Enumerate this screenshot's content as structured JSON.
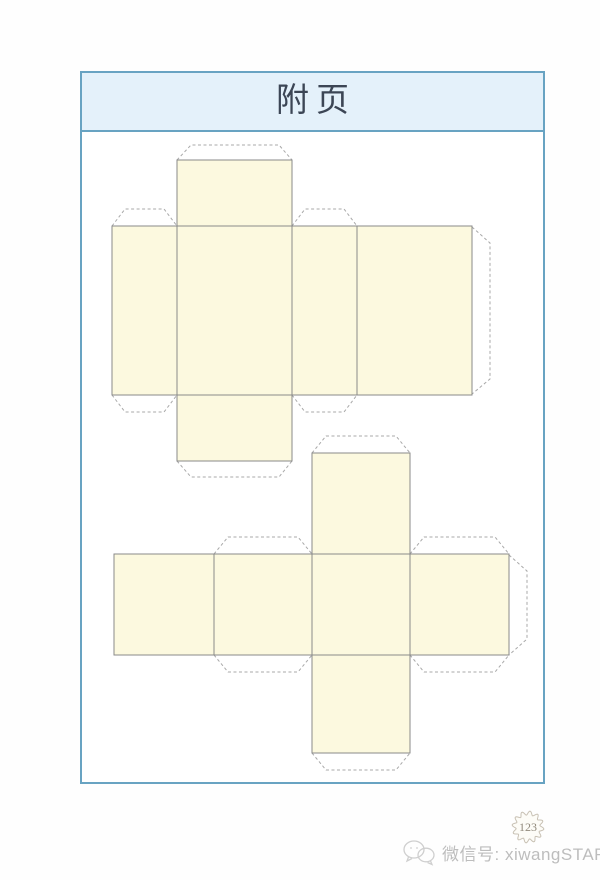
{
  "page": {
    "title": "附页",
    "page_number": "123",
    "watermark_text": "微信号: xiwangSTAR"
  },
  "colors": {
    "frame_border": "#68a3c2",
    "header_fill": "#e4f1fa",
    "title_color": "#3c4655",
    "face_fill": "#fcf9df",
    "solid_line": "#8a8a8a",
    "dashed_line": "#a9a9a9",
    "watermark": "#bdbdbd",
    "wechat_icon_stroke": "#cfcfcf",
    "badge_stroke": "#c8c1b4",
    "badge_fill": "#fdfcf7",
    "badge_text": "#918a7c"
  },
  "nets": [
    {
      "name": "cuboid-box-net",
      "faces": [
        [
          177,
          160,
          115,
          66
        ],
        [
          112,
          226,
          65,
          169
        ],
        [
          177,
          226,
          115,
          169
        ],
        [
          292,
          226,
          65,
          169
        ],
        [
          357,
          226,
          115,
          169
        ],
        [
          177,
          395,
          115,
          66
        ]
      ],
      "tabs": [
        [
          [
            177,
            160
          ],
          [
            191,
            145
          ],
          [
            279,
            145
          ],
          [
            292,
            160
          ]
        ],
        [
          [
            112,
            226
          ],
          [
            125,
            209
          ],
          [
            164,
            209
          ],
          [
            177,
            226
          ]
        ],
        [
          [
            292,
            226
          ],
          [
            305,
            209
          ],
          [
            344,
            209
          ],
          [
            357,
            226
          ]
        ],
        [
          [
            472,
            227
          ],
          [
            490,
            243
          ],
          [
            490,
            379
          ],
          [
            472,
            394
          ]
        ],
        [
          [
            112,
            395
          ],
          [
            125,
            412
          ],
          [
            164,
            412
          ],
          [
            177,
            395
          ]
        ],
        [
          [
            292,
            395
          ],
          [
            305,
            412
          ],
          [
            344,
            412
          ],
          [
            357,
            395
          ]
        ],
        [
          [
            177,
            461
          ],
          [
            191,
            477
          ],
          [
            279,
            477
          ],
          [
            292,
            461
          ]
        ]
      ]
    },
    {
      "name": "cube-box-net",
      "faces": [
        [
          312,
          453,
          98,
          101
        ],
        [
          114,
          554,
          100,
          101
        ],
        [
          214,
          554,
          98,
          101
        ],
        [
          312,
          554,
          98,
          101
        ],
        [
          410,
          554,
          99,
          101
        ],
        [
          312,
          655,
          98,
          98
        ]
      ],
      "tabs": [
        [
          [
            312,
            453
          ],
          [
            326,
            436
          ],
          [
            396,
            436
          ],
          [
            410,
            453
          ]
        ],
        [
          [
            214,
            554
          ],
          [
            228,
            537
          ],
          [
            298,
            537
          ],
          [
            312,
            554
          ]
        ],
        [
          [
            410,
            554
          ],
          [
            424,
            537
          ],
          [
            495,
            537
          ],
          [
            509,
            554
          ]
        ],
        [
          [
            509,
            555
          ],
          [
            527,
            571
          ],
          [
            527,
            639
          ],
          [
            509,
            655
          ]
        ],
        [
          [
            214,
            655
          ],
          [
            228,
            672
          ],
          [
            298,
            672
          ],
          [
            312,
            655
          ]
        ],
        [
          [
            410,
            655
          ],
          [
            424,
            672
          ],
          [
            495,
            672
          ],
          [
            509,
            655
          ]
        ],
        [
          [
            312,
            753
          ],
          [
            326,
            770
          ],
          [
            396,
            770
          ],
          [
            410,
            753
          ]
        ]
      ]
    }
  ]
}
